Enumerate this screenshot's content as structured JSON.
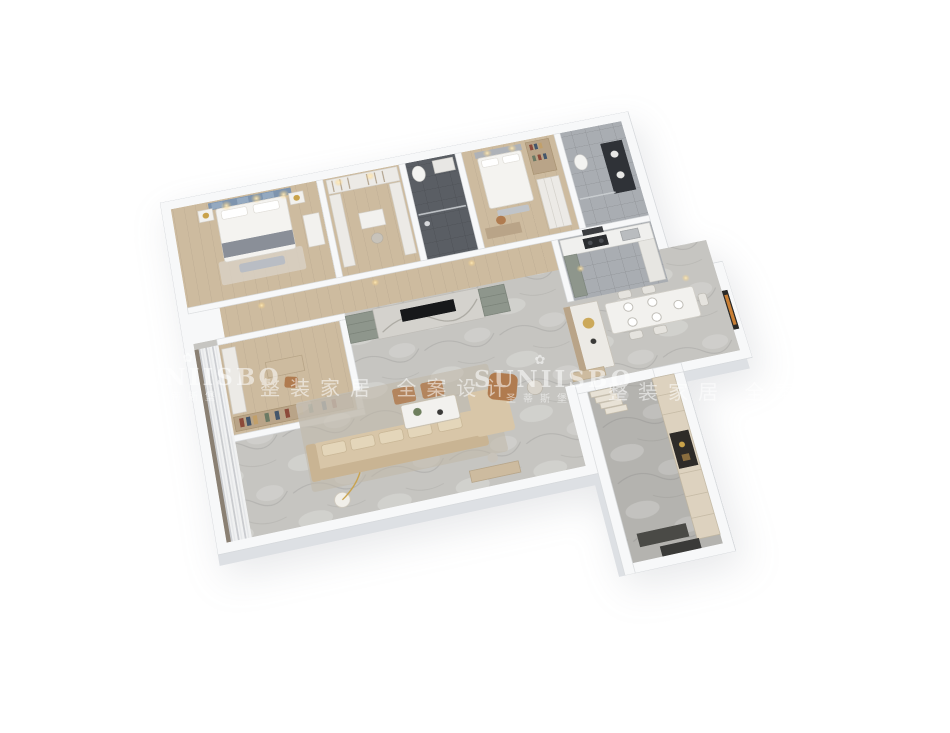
{
  "watermark": {
    "brand_latin": "SUNIISBO",
    "brand_chinese": "圣蒂斯堡",
    "slogan_chinese": "整装家居 全案设计",
    "icon_glyph": "✿",
    "text_color": "#ffffff",
    "opacity": "0.55"
  },
  "scene": {
    "description": "3D dollhouse-style floor plan render of an apartment, rotated isometric top view on white background",
    "rooms": [
      {
        "name": "master-bedroom",
        "floor": "wood"
      },
      {
        "name": "walk-in-closet",
        "floor": "wood"
      },
      {
        "name": "dark-bathroom",
        "floor": "dark-tile"
      },
      {
        "name": "bedroom-2",
        "floor": "wood"
      },
      {
        "name": "bathroom-2",
        "floor": "gray-tile"
      },
      {
        "name": "study",
        "floor": "wood"
      },
      {
        "name": "hallway",
        "floor": "wood"
      },
      {
        "name": "kitchen",
        "floor": "gray-tile"
      },
      {
        "name": "dining-room",
        "floor": "marble"
      },
      {
        "name": "living-room",
        "floor": "marble"
      },
      {
        "name": "balcony-window",
        "floor": "wood"
      },
      {
        "name": "entry-hall",
        "floor": "marble"
      }
    ],
    "colors": {
      "background": "#ffffff",
      "wall": "#f7f8f9",
      "wall_side": "#dde0e4",
      "wall_edge": "#d7dadd",
      "wood": "#cdbb9f",
      "wood_dark": "#b9a488",
      "marble": "#c6c5c1",
      "marble_dark": "#b4b3af",
      "gray_tile": "#a9adb2",
      "dark_tile": "#5a5e64",
      "sofa_beige": "#d8c6a8",
      "sofa_dark": "#c9b493",
      "leather_tan": "#b07b4f",
      "cabinet_green": "#8e968c",
      "headboard_blue": "#7e94ae",
      "gold": "#c9a24a",
      "tv_black": "#17181a",
      "white_furniture": "#f2f1ee"
    }
  }
}
